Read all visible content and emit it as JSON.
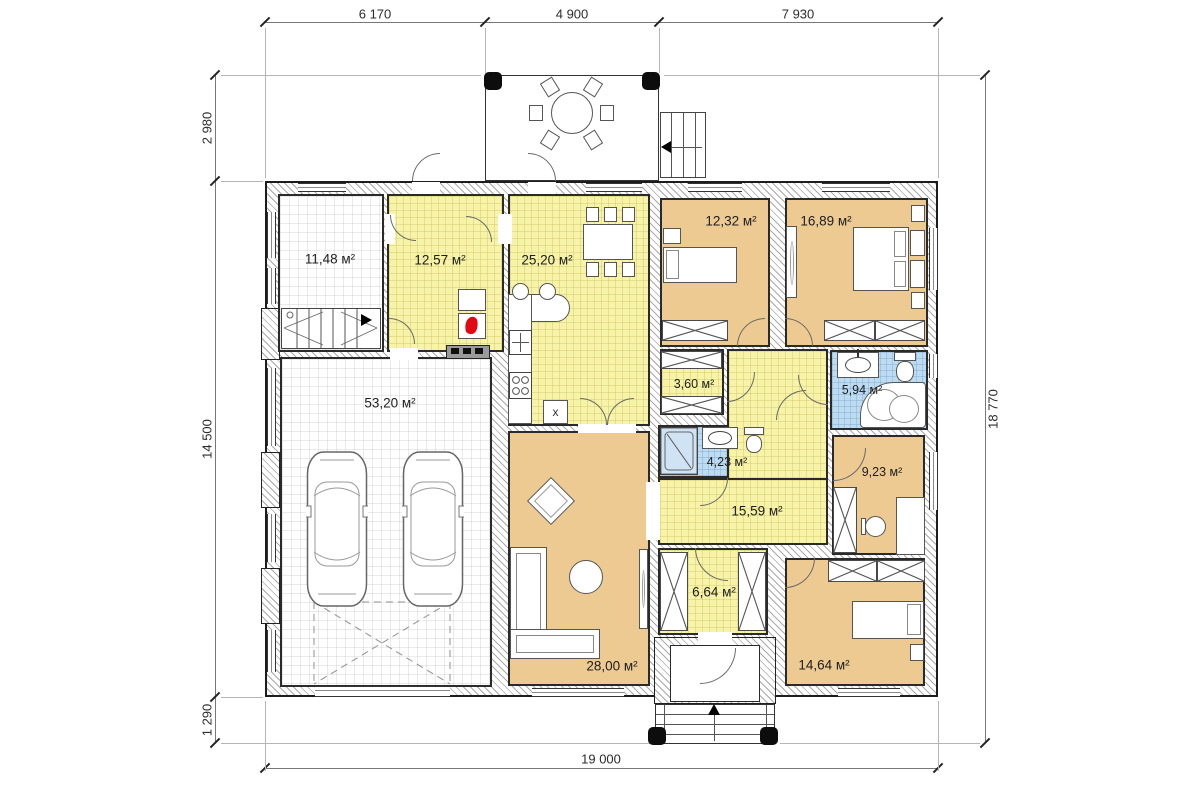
{
  "dims": {
    "top": [
      "6 170",
      "4 900",
      "7 930"
    ],
    "left": [
      "2 980",
      "14 500",
      "1 290"
    ],
    "right": "18 770",
    "bottom": "19 000"
  },
  "rooms": {
    "boiler": "11,48 м²",
    "entry_hall": "12,57 м²",
    "kitchen": "25,20 м²",
    "garage": "53,20 м²",
    "living": "28,00 м²",
    "bedroom1": "12,32 м²",
    "bedroom2": "16,89 м²",
    "closet": "3,60 м²",
    "bath1": "5,94 м²",
    "bath2": "4,23 м²",
    "hall": "15,59 м²",
    "office": "9,23 м²",
    "vestibule": "6,64 м²",
    "bedroom3": "14,64 м²"
  },
  "kitchen": {
    "x_cabinet": "x"
  },
  "colors": {
    "room_yellow": "#f7f3a8",
    "room_tan": "#ecca92",
    "room_blue": "#bedcf1",
    "wall_line": "#1c1c1c",
    "flame_red": "#e30613"
  }
}
